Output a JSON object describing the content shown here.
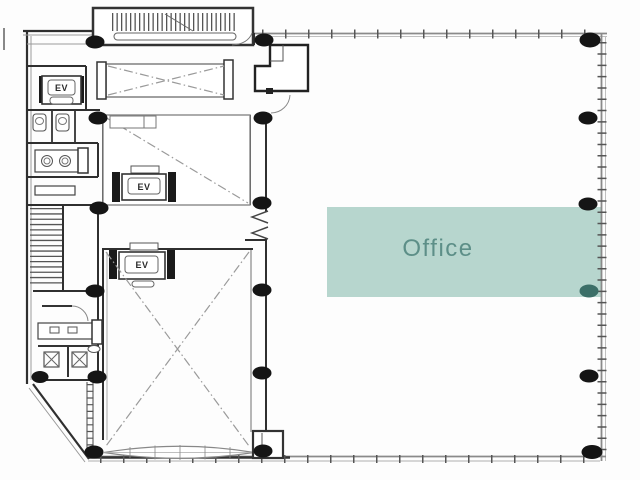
{
  "floorplan": {
    "office_zone": {
      "label": "Office"
    },
    "elevators": [
      {
        "label": "EV"
      },
      {
        "label": "EV"
      },
      {
        "label": "EV"
      }
    ],
    "colors": {
      "background": "#fdfdfd",
      "wall_dark": "#2f2f2f",
      "wall_gray": "#8a8a8a",
      "wall_light": "#c0c0c0",
      "hatch_gray": "#555555",
      "diagonal_gray": "#9a9a9a",
      "column_black": "#151515",
      "office_fill": "#b7d6ce",
      "office_text": "#5d8f88",
      "office_column": "#3c6f68"
    }
  }
}
